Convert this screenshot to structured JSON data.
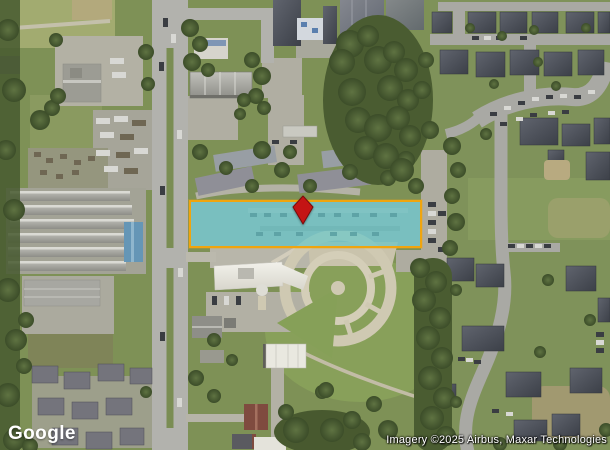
{
  "map": {
    "provider_logo": "Google",
    "attribution": "Imagery ©2025 Airbus, Maxar Technologies"
  },
  "parcel_overlay": {
    "fill_color": "#4dc6cf",
    "fill_opacity": "0.55",
    "border_color": "#f0a50e"
  },
  "pin": {
    "color": "#c41414",
    "outline_color": "#7a0b0b"
  }
}
